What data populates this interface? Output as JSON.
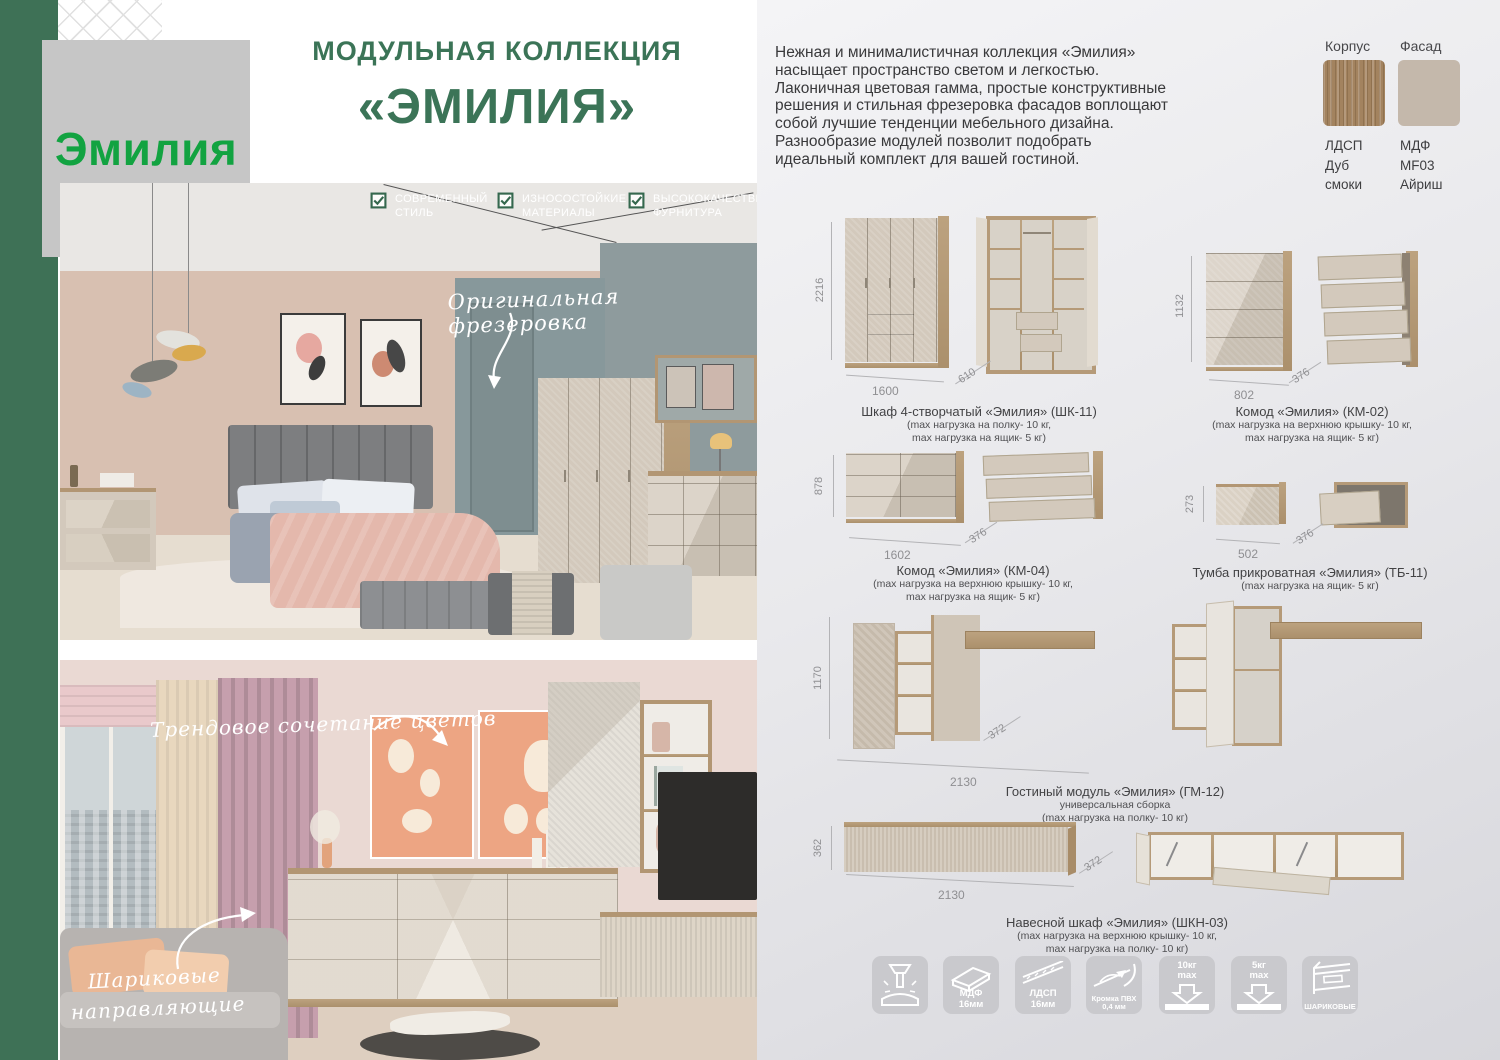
{
  "brand": {
    "logo_text": "Эмилия"
  },
  "header": {
    "line1": "МОДУЛЬНАЯ КОЛЛЕКЦИЯ",
    "line2": "«ЭМИЛИЯ»"
  },
  "features": [
    {
      "line1": "СОВРЕМЕННЫЙ",
      "line2": "СТИЛЬ"
    },
    {
      "line1": "ИЗНОСОСТОЙКИЕ",
      "line2": "МАТЕРИАЛЫ"
    },
    {
      "line1": "ВЫСОКОКАЧЕСТВЕ",
      "line2": "ФУРНИТУРА"
    }
  ],
  "intro": {
    "text": "Нежная и минималистичная коллекция «Эмилия» насыщает пространство светом и легкостью. Лаконичная цветовая гамма, простые конструктивные решения и стильная фрезеровка фасадов воплощают собой лучшие тенденции мебельного дизайна. Разнообразие модулей позволит подобрать идеальный комплект для вашей гостиной."
  },
  "materials": {
    "korpus": {
      "label": "Корпус",
      "lines": [
        "ЛДСП",
        "Дуб",
        "смоки"
      ]
    },
    "fasad": {
      "label": "Фасад",
      "lines": [
        "МДФ",
        "MF03",
        "Айриш"
      ]
    }
  },
  "photos": {
    "bedroom": {
      "annotation": "Оригинальная фрезеровка"
    },
    "living": {
      "annotation_top": "Трендовое сочетание цветов",
      "annotation_bottom1": "Шариковые",
      "annotation_bottom2": "направляющие"
    }
  },
  "products": [
    {
      "name": "Шкаф 4-створчатый «Эмилия» (ШК-11)",
      "note1": "(max нагрузка на полку- 10 кг,",
      "note2": "max нагрузка на ящик- 5 кг)",
      "h": "2216",
      "w": "1600",
      "d": "610"
    },
    {
      "name": "Комод «Эмилия» (КМ-02)",
      "note1": "(max нагрузка на верхнюю крышку- 10 кг,",
      "note2": "max нагрузка на ящик- 5 кг)",
      "h": "1132",
      "w": "802",
      "d": "376"
    },
    {
      "name": "Комод «Эмилия» (КМ-04)",
      "note1": "(max нагрузка на верхнюю крышку- 10 кг,",
      "note2": "max нагрузка на ящик- 5 кг)",
      "h": "878",
      "w": "1602",
      "d": "376"
    },
    {
      "name": "Тумба прикроватная «Эмилия» (ТБ-11)",
      "note1": "(max нагрузка на ящик- 5 кг)",
      "note2": "",
      "h": "273",
      "w": "502",
      "d": "376"
    },
    {
      "name": "Гостиный модуль «Эмилия» (ГМ-12)",
      "sub": "универсальная сборка",
      "note1": "(max нагрузка на полку- 10 кг)",
      "note2": "",
      "h": "1170",
      "w": "2130",
      "d": "372"
    },
    {
      "name": "Навесной шкаф «Эмилия» (ШКН-03)",
      "note1": "(max нагрузка на верхнюю крышку- 10 кг,",
      "note2": "max нагрузка на полку- 10 кг)",
      "h": "362",
      "w": "2130",
      "d": "372"
    }
  ],
  "badges": [
    {
      "line1": "",
      "line2": ""
    },
    {
      "line1": "МДФ",
      "line2": "16мм"
    },
    {
      "line1": "ЛДСП",
      "line2": "16мм"
    },
    {
      "line1": "Кромка ПВХ",
      "line2": "0,4 мм"
    },
    {
      "line1": "10кг",
      "line2": "max"
    },
    {
      "line1": "5кг",
      "line2": "max"
    },
    {
      "line1": "ШАРИКОВЫЕ",
      "line2": ""
    }
  ],
  "colors": {
    "accent_green": "#3e7156",
    "title_green": "#3b7457",
    "logo_green": "#12a341",
    "panel_gray": "#e9e9ec",
    "front_beige": "#d3c9bc",
    "wood": "#b29673"
  }
}
